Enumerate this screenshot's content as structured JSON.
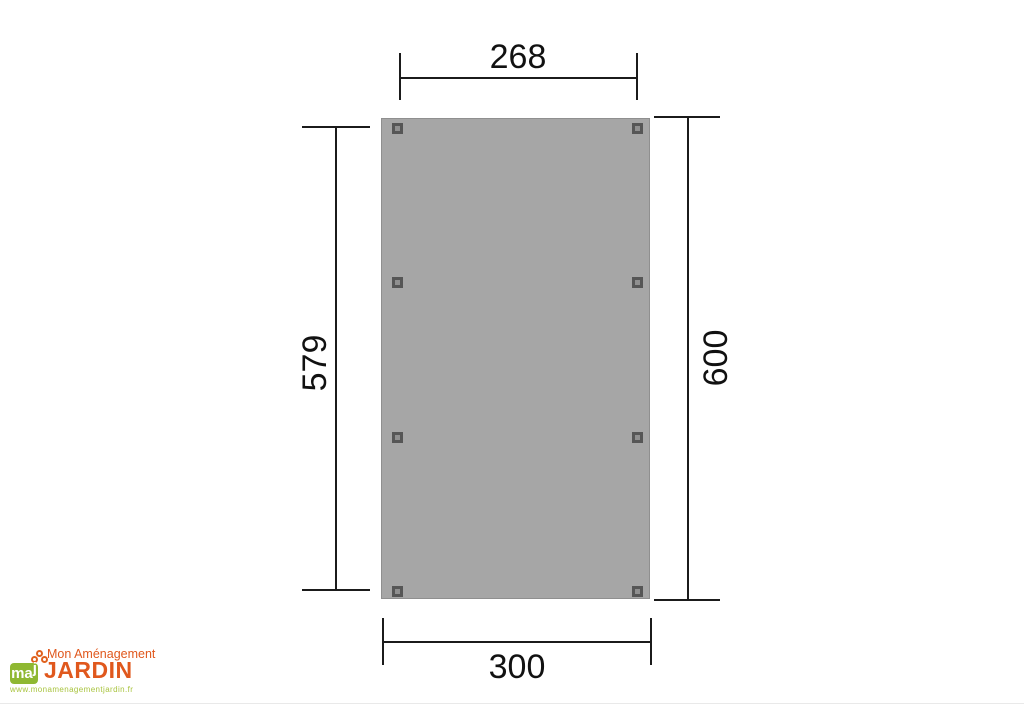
{
  "diagram": {
    "type": "carport-footprint-dimension-drawing",
    "slab": {
      "fill": "#a6a6a6",
      "border": "#8f8f8f",
      "post_color": "#565656",
      "post_count": 8
    },
    "dimensions": {
      "top": {
        "value": "268",
        "orientation": "horizontal",
        "position": "above-slab"
      },
      "bottom": {
        "value": "300",
        "orientation": "horizontal",
        "position": "below-slab"
      },
      "left": {
        "value": "579",
        "orientation": "vertical",
        "position": "left-of-slab"
      },
      "right": {
        "value": "600",
        "orientation": "vertical",
        "position": "right-of-slab"
      }
    },
    "line_color": "#1b1b1b"
  },
  "logo": {
    "tagline": "Mon Aménagement",
    "name": "JARDIN",
    "monogram_ma": "ma",
    "monogram_j": "j",
    "url": "www.monamenagementjardin.fr",
    "orange": "#e0581d",
    "green": "#8fb832",
    "url_color": "#a9c43f"
  }
}
